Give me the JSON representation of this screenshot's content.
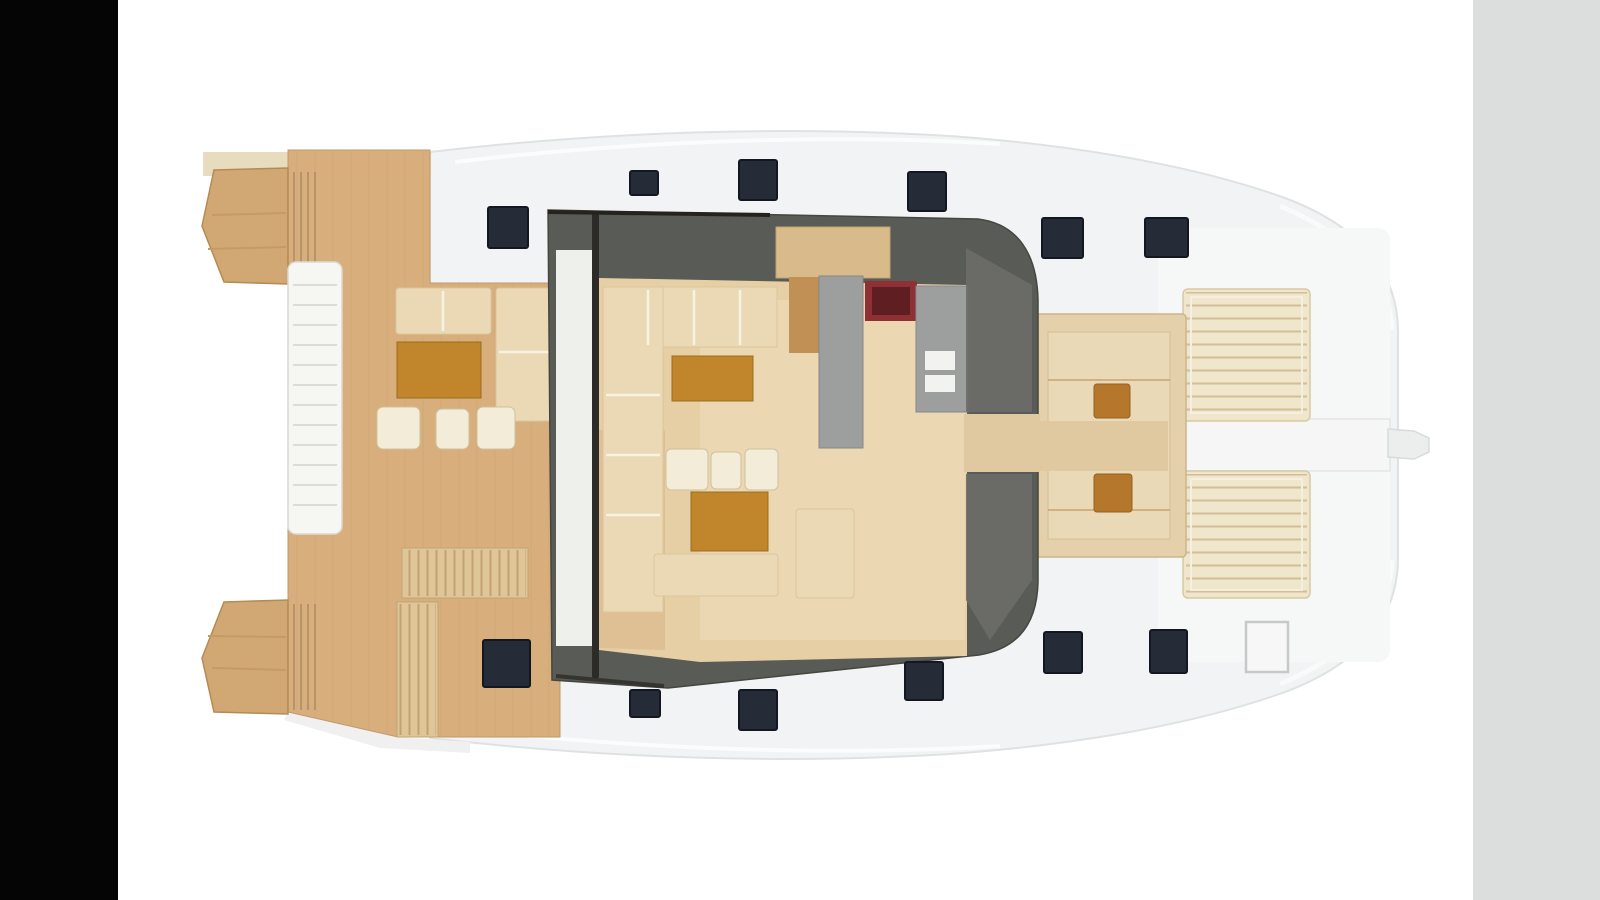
{
  "meta": {
    "scene": "catamaran-main-deck-floor-plan",
    "orientation": "bow-right-stern-left",
    "visible_text": []
  },
  "inventory": {
    "deck_hatches": 12,
    "sunpads": 2,
    "foredeck_tables": 2,
    "aft_deck_stools": 3,
    "saloon_chairs": 3,
    "saloon_tables": 2,
    "galley_stove": 1,
    "boarding_steps": 2
  },
  "palette": {
    "page_background": "#ffffff",
    "letterbox_left": "#050505",
    "letterbox_right": "#dcdddd",
    "hull": "#f2f3f4",
    "hull_sliver": "#eff0ef",
    "foredeck_white": "#f6f7f7",
    "deck_teak": "#d7ae7c",
    "deck_trim": "#e8dcbe",
    "step_block": "#d1a874",
    "slat_wood": "#dec699",
    "gangway_white": "#f6f6f3",
    "side_passage": "#eef0ec",
    "saloon_roof": "#595b57",
    "saloon_edge": "#26231f",
    "floor_tan": "#e6cfa4",
    "floor_light": "#eedfbd",
    "floor_shade": "#d8b284",
    "sofa_cream": "#ead9b4",
    "chair_cream": "#f2ecd9",
    "table_brown": "#c1862b",
    "small_table_brown": "#b5772c",
    "cabinet_tan": "#d9ba8a",
    "cabinet_wood": "#c09055",
    "galley_gray": "#9d9f9e",
    "galley_gray_dark": "#6b6d69",
    "stove_red": "#8e3034",
    "stove_red_dark": "#5f1e22",
    "drawer_white": "#f2f2f0",
    "hatch_navy": "#262b38",
    "sunpad_cream": "#efe6cb",
    "cockpit_tan": "#e4d1ab",
    "cockpit_tan_light": "#e9d9b7",
    "walkway_tan": "#e0c9a0",
    "walkway_white": "#f5f6f5",
    "bowsprit_gray": "#eceeee",
    "locker_white": "#f6f7f6"
  }
}
